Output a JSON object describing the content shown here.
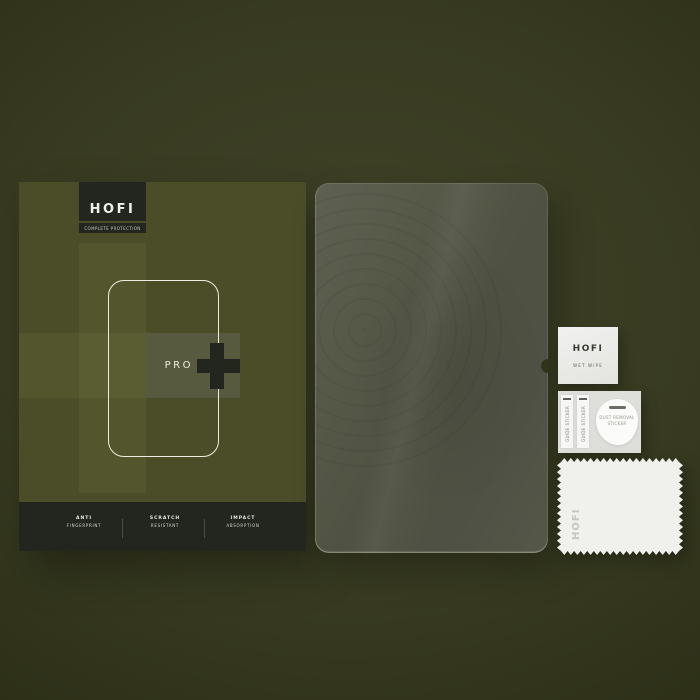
{
  "box": {
    "brand": "HOFI",
    "tagline": "COMPLETE PROTECTION",
    "model": "PRO",
    "features": [
      {
        "line1": "ANTI",
        "line2": "FINGERPRINT"
      },
      {
        "line1": "SCRATCH",
        "line2": "RESISTANT"
      },
      {
        "line1": "IMPACT",
        "line2": "ABSORPTION"
      }
    ]
  },
  "accessories": {
    "wet_wipe": {
      "brand": "HOFI",
      "label": "WET WIPE"
    },
    "sticker_sheet": {
      "guide_sticker": "GUIDE STICKER",
      "dust_removal_line1": "DUST REMOVAL",
      "dust_removal_line2": "STICKER"
    },
    "cloth": {
      "brand": "HOFI"
    }
  },
  "colors": {
    "background": "#383b21",
    "box_base": "#4a4d28",
    "box_stripe": "#53562d",
    "box_dark": "#23261e",
    "outline_cream": "#eeeede",
    "glass_tint": "#51534a",
    "paper_white": "#f0f0ec"
  }
}
